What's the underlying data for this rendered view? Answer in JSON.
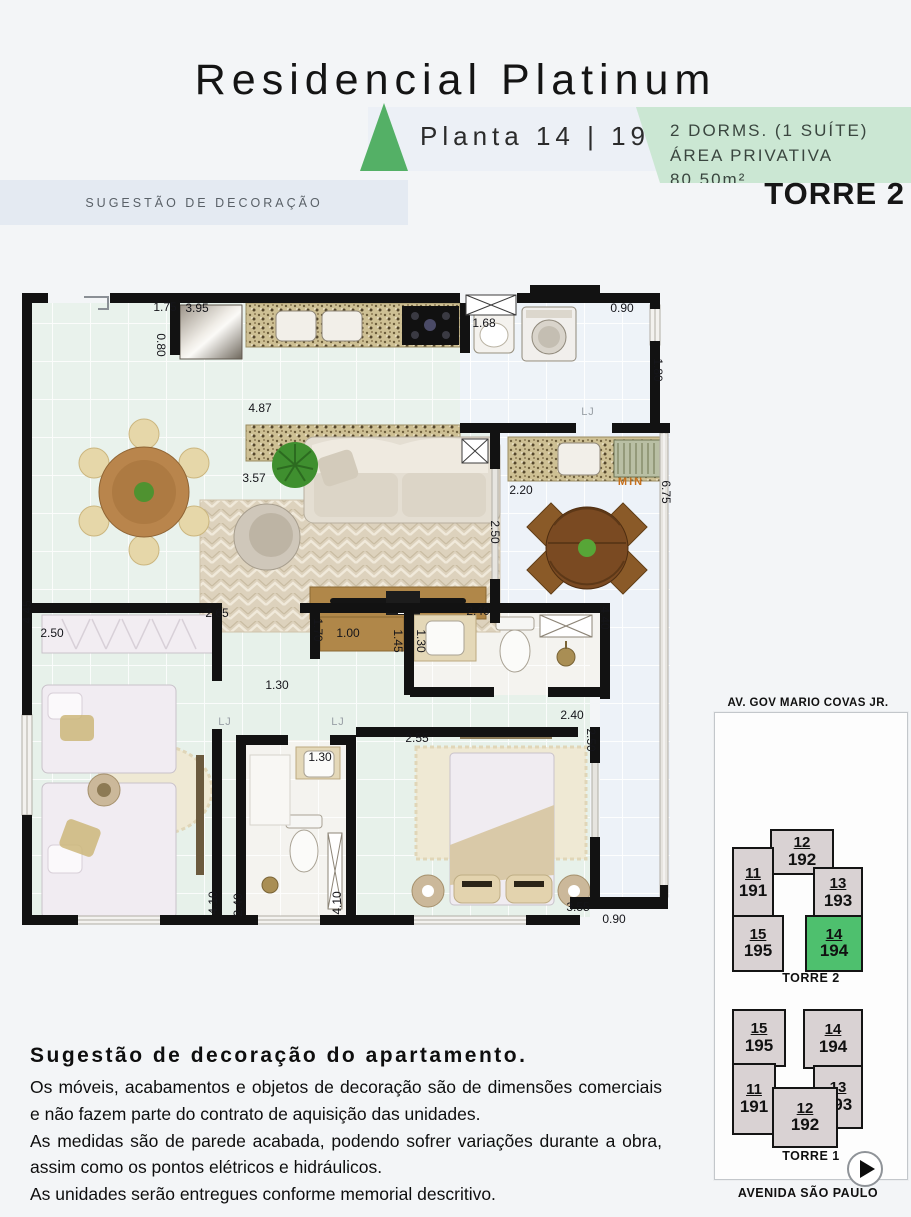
{
  "header": {
    "title": "Residencial Platinum",
    "plan_label": "Planta 14 | 194",
    "banner_line1": "2 DORMS. (1 SUÍTE)",
    "banner_line2": "ÁREA PRIVATIVA 80,50m²",
    "tower_label": "TORRE 2",
    "decor_bar": "SUGESTÃO DE DECORAÇÃO",
    "accent_green": "#54b066",
    "banner_green": "#cbe7d3"
  },
  "plan": {
    "highlight_color": "#4ec06e",
    "dims": [
      {
        "t": "1.75",
        "x": 151,
        "y": 22
      },
      {
        "t": "3.95",
        "x": 183,
        "y": 23
      },
      {
        "t": "0.80",
        "x": 147,
        "y": 60,
        "r": 90
      },
      {
        "t": "1.68",
        "x": 470,
        "y": 38
      },
      {
        "t": "0.90",
        "x": 608,
        "y": 23
      },
      {
        "t": "1.80",
        "x": 644,
        "y": 85,
        "r": 90
      },
      {
        "t": "4.87",
        "x": 246,
        "y": 123
      },
      {
        "t": "3.57",
        "x": 240,
        "y": 193
      },
      {
        "t": "2.20",
        "x": 507,
        "y": 205
      },
      {
        "t": "6.75",
        "x": 652,
        "y": 207,
        "r": 90
      },
      {
        "t": "MIN",
        "x": 617,
        "y": 197,
        "c": "min"
      },
      {
        "t": "2.50",
        "x": 481,
        "y": 247,
        "r": 90
      },
      {
        "t": "2.40",
        "x": 464,
        "y": 326
      },
      {
        "t": "4.40",
        "x": 591,
        "y": 333,
        "r": 90
      },
      {
        "t": "2.65",
        "x": 203,
        "y": 328
      },
      {
        "t": "4.45",
        "x": 13,
        "y": 327,
        "r": -90
      },
      {
        "t": "2.50",
        "x": 38,
        "y": 348
      },
      {
        "t": "1.70",
        "x": 304,
        "y": 345,
        "r": 90
      },
      {
        "t": "1.00",
        "x": 334,
        "y": 348
      },
      {
        "t": "1.45",
        "x": 384,
        "y": 356,
        "r": 90
      },
      {
        "t": "1.30",
        "x": 407,
        "y": 356,
        "r": 90
      },
      {
        "t": "1.30",
        "x": 263,
        "y": 400
      },
      {
        "t": "LJ",
        "x": 211,
        "y": 437,
        "c": "lj"
      },
      {
        "t": "LJ",
        "x": 324,
        "y": 437,
        "c": "lj"
      },
      {
        "t": "LJ",
        "x": 574,
        "y": 127,
        "c": "lj"
      },
      {
        "t": "2.40",
        "x": 558,
        "y": 430
      },
      {
        "t": "2.55",
        "x": 403,
        "y": 453
      },
      {
        "t": "2.50",
        "x": 577,
        "y": 455,
        "r": 90
      },
      {
        "t": "1.30",
        "x": 306,
        "y": 472
      },
      {
        "t": "4.10",
        "x": 199,
        "y": 618,
        "r": -90
      },
      {
        "t": "2.40",
        "x": 224,
        "y": 620,
        "r": -90
      },
      {
        "t": "4.10",
        "x": 323,
        "y": 618,
        "r": -90
      },
      {
        "t": "3.55",
        "x": 564,
        "y": 622
      },
      {
        "t": "0.90",
        "x": 600,
        "y": 634
      }
    ]
  },
  "keyplan": {
    "street_top": "AV. GOV MARIO COVAS JR.",
    "street_bottom": "AVENIDA SÃO PAULO",
    "torre2": {
      "caption": "TORRE 2",
      "units": [
        {
          "floor": "12",
          "unit": "192",
          "highlighted": false
        },
        {
          "floor": "11",
          "unit": "191",
          "highlighted": false
        },
        {
          "floor": "13",
          "unit": "193",
          "highlighted": false
        },
        {
          "floor": "15",
          "unit": "195",
          "highlighted": false
        },
        {
          "floor": "14",
          "unit": "194",
          "highlighted": true
        }
      ]
    },
    "torre1": {
      "caption": "TORRE 1",
      "units": [
        {
          "floor": "15",
          "unit": "195",
          "highlighted": false
        },
        {
          "floor": "14",
          "unit": "194",
          "highlighted": false
        },
        {
          "floor": "11",
          "unit": "191",
          "highlighted": false
        },
        {
          "floor": "13",
          "unit": "193",
          "highlighted": false
        },
        {
          "floor": "12",
          "unit": "192",
          "highlighted": false
        }
      ]
    }
  },
  "disclaimer": {
    "heading": "Sugestão de decoração do apartamento.",
    "paragraphs": [
      "Os móveis, acabamentos e objetos de decoração são de dimensões comerciais e não fazem parte do contrato de aquisição das unidades.",
      "As medidas são de parede acabada, podendo sofrer variações durante a obra, assim como os pontos elétricos e hidráulicos.",
      "As unidades serão entregues conforme memorial descritivo."
    ]
  }
}
